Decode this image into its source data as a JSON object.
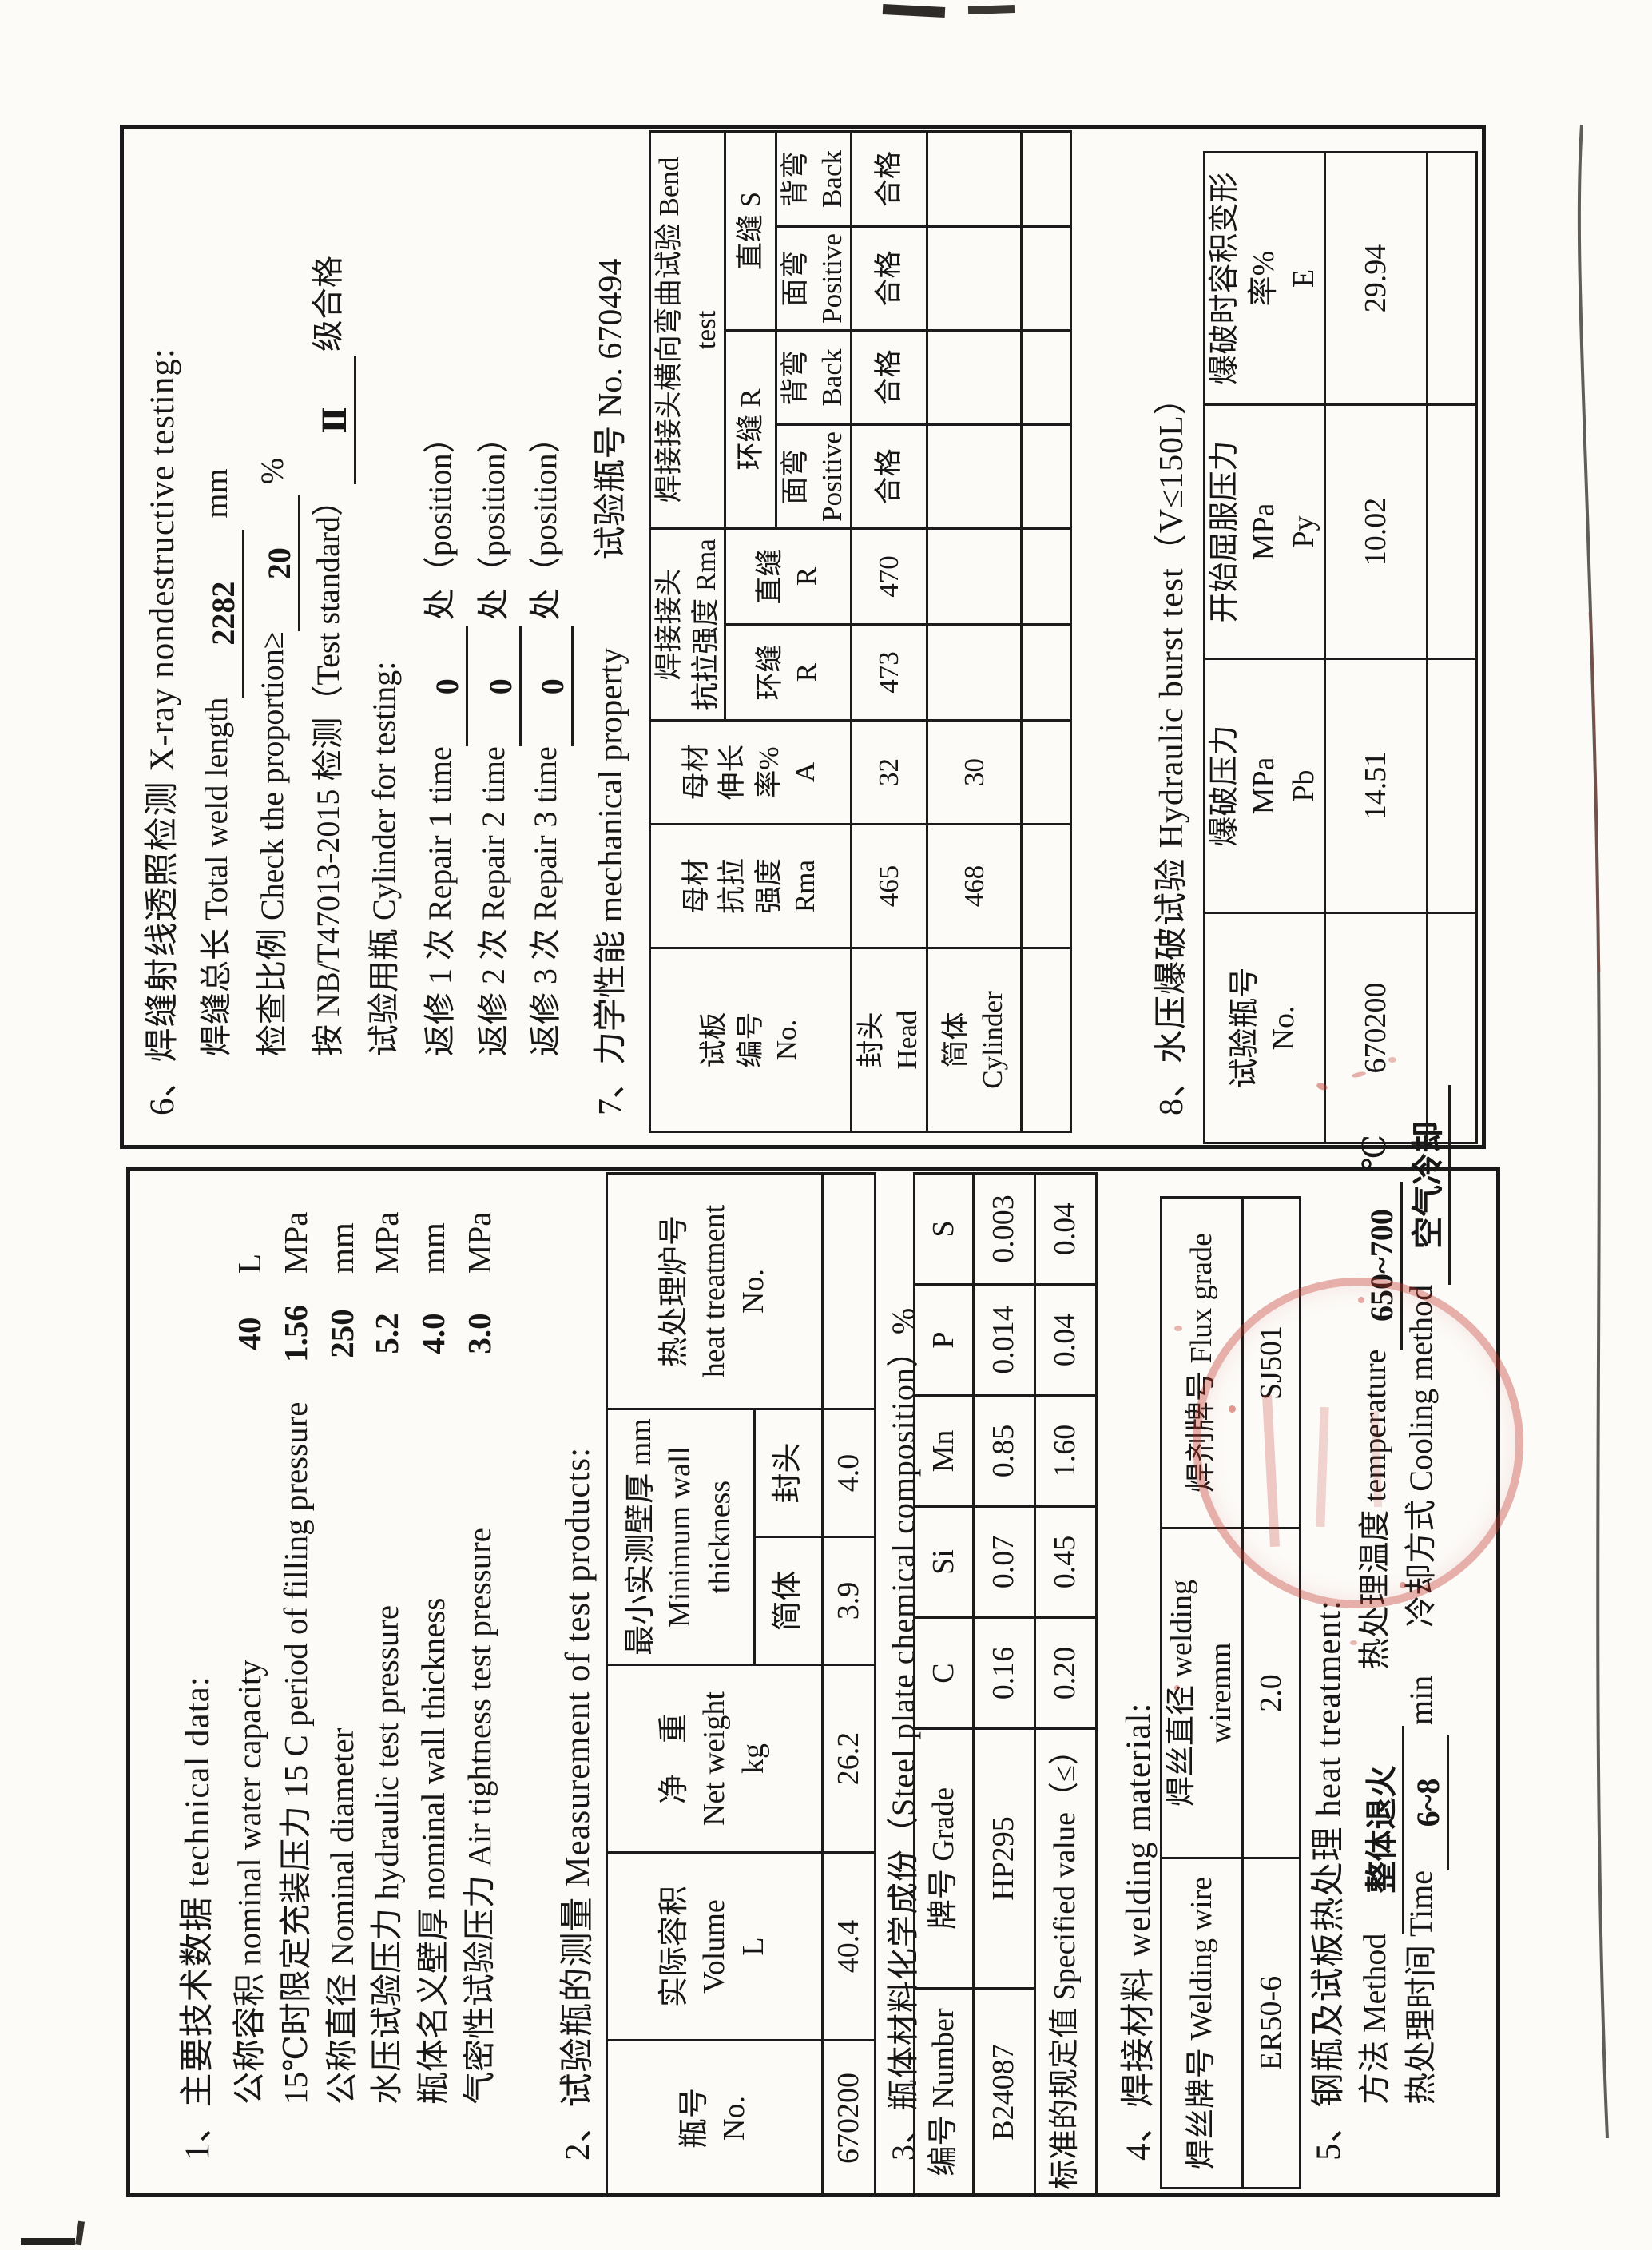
{
  "doc": {
    "ink": "#1a1a1a",
    "stamp_color": "#c23428"
  },
  "left_box": {
    "s1_heading": "1、主要技术数据 technical data:",
    "s1_items": [
      {
        "label": "公称容积 nominal water capacity",
        "value": "40",
        "unit": "L"
      },
      {
        "label": "15℃时限定充装压力 15 C period of filling pressure",
        "value": "1.56",
        "unit": "MPa"
      },
      {
        "label": "公称直径 Nominal diameter",
        "value": "250",
        "unit": "mm"
      },
      {
        "label": "水压试验压力 hydraulic test pressure",
        "value": "5.2",
        "unit": "MPa"
      },
      {
        "label": "瓶体名义壁厚 nominal wall thickness",
        "value": "4.0",
        "unit": "mm"
      },
      {
        "label": "气密性试验压力 Air tightness test pressure",
        "value": "3.0",
        "unit": "MPa"
      }
    ],
    "s2_heading": "2、试验瓶的测量  Measurement of test products:",
    "s2_table": {
      "h_no": "瓶号\nNo.",
      "h_volume": "实际容积\nVolume\nL",
      "h_weight": "净　重\nNet weight\nkg",
      "h_minwall": "最小实测壁厚 mm\nMinimum wall thickness",
      "h_body": "简体",
      "h_head": "封头",
      "h_furnace": "热处理炉号\nheat treatment\nNo.",
      "row": [
        "670200",
        "40.4",
        "26.2",
        "3.9",
        "4.0",
        ""
      ]
    },
    "s3_heading": "3、瓶体材料化学成份（Steel plate chemical composition）%",
    "s3_table": {
      "headers": [
        "编号 Number",
        "牌号 Grade",
        "C",
        "Si",
        "Mn",
        "P",
        "S"
      ],
      "row1": [
        "B24087",
        "HP295",
        "0.16",
        "0.07",
        "0.85",
        "0.014",
        "0.003"
      ],
      "row2_label": "标准的规定值 Specified value（≤）",
      "row2": [
        "0.20",
        "0.45",
        "1.60",
        "0.04",
        "0.04"
      ]
    },
    "s4_heading": "4、焊接材料 welding material:",
    "s4_table": {
      "headers": [
        "焊丝牌号 Welding wire",
        "焊丝直径 welding wiremm",
        "焊剂牌号 Flux grade"
      ],
      "row": [
        "ER50-6",
        "2.0",
        "SJ501"
      ]
    },
    "s5_heading": "5、钢瓶及试板热处理 heat treatment:",
    "s5_line1": {
      "l1": "方法 Method",
      "v1": "整体退火",
      "l2": "热处理温度 temperature",
      "v2": "650~700",
      "u2": "℃"
    },
    "s5_line2": {
      "l1": "热处理时间 Time",
      "v1": "6~8",
      "u1": "min",
      "l2": "冷却方式 Cooling method",
      "v2": "空气冷却"
    }
  },
  "right_box": {
    "s6_heading": "6、焊缝射线透照检测 X-ray nondestructive testing:",
    "s6_lines": [
      {
        "label": "焊缝总长 Total weld length",
        "value": "2282",
        "suffix": "mm"
      },
      {
        "label": "检查比例 Check the proportion≥",
        "value": "20",
        "suffix": "%"
      },
      {
        "label": "按 NB/T47013-2015 检测（Test standard）",
        "value": "Ⅱ",
        "suffix": "级合格"
      },
      {
        "label": "试验用瓶 Cylinder for testing:",
        "value": "",
        "suffix": ""
      },
      {
        "label": "返修 1 次 Repair 1 time",
        "value": "0",
        "suffix": "处（position）"
      },
      {
        "label": "返修 2 次 Repair 2 time",
        "value": "0",
        "suffix": "处（position）"
      },
      {
        "label": "返修 3 次 Repair 3 time",
        "value": "0",
        "suffix": "处（position）"
      }
    ],
    "s7_heading": "7、力学性能 mechanical property",
    "s7_bottle": "试验瓶号 No. 670494",
    "s7_table": {
      "h_plate": "试板\n编号\nNo.",
      "h_base_tensile": "母材\n抗拉\n强度\nRma",
      "h_base_elong": "母材\n伸长\n率%\nA",
      "h_joint_tensile": "焊接接头\n抗拉强度 Rma",
      "h_ring_r": "环缝\nR",
      "h_straight_r": "直缝\nR",
      "h_bend": "焊接接头横向弯曲试验 Bend test",
      "h_bend_ring": "环缝 R",
      "h_bend_straight": "直缝 S",
      "h_face": "面弯\nPositive",
      "h_back": "背弯\nBack",
      "rows": [
        {
          "label": "封头\nHead",
          "cells": [
            "465",
            "32",
            "473",
            "470",
            "合格",
            "合格",
            "合格",
            "合格"
          ]
        },
        {
          "label": "简体\nCylinder",
          "cells": [
            "468",
            "30",
            "",
            "",
            "",
            "",
            "",
            ""
          ]
        },
        {
          "label": "",
          "cells": [
            "",
            "",
            "",
            "",
            "",
            "",
            "",
            ""
          ]
        }
      ]
    },
    "s8_heading": "8、水压爆破试验 Hydraulic burst test（V≤150L）",
    "s8_table": {
      "headers": [
        "试验瓶号\nNo.",
        "爆破压力\nMPa\nPb",
        "开始屈服压力\nMPa\nPy",
        "爆破时容积变形\n率%\nE"
      ],
      "row": [
        "670200",
        "14.51",
        "10.02",
        "29.94"
      ],
      "empty_row": [
        "",
        "",
        "",
        ""
      ]
    }
  }
}
